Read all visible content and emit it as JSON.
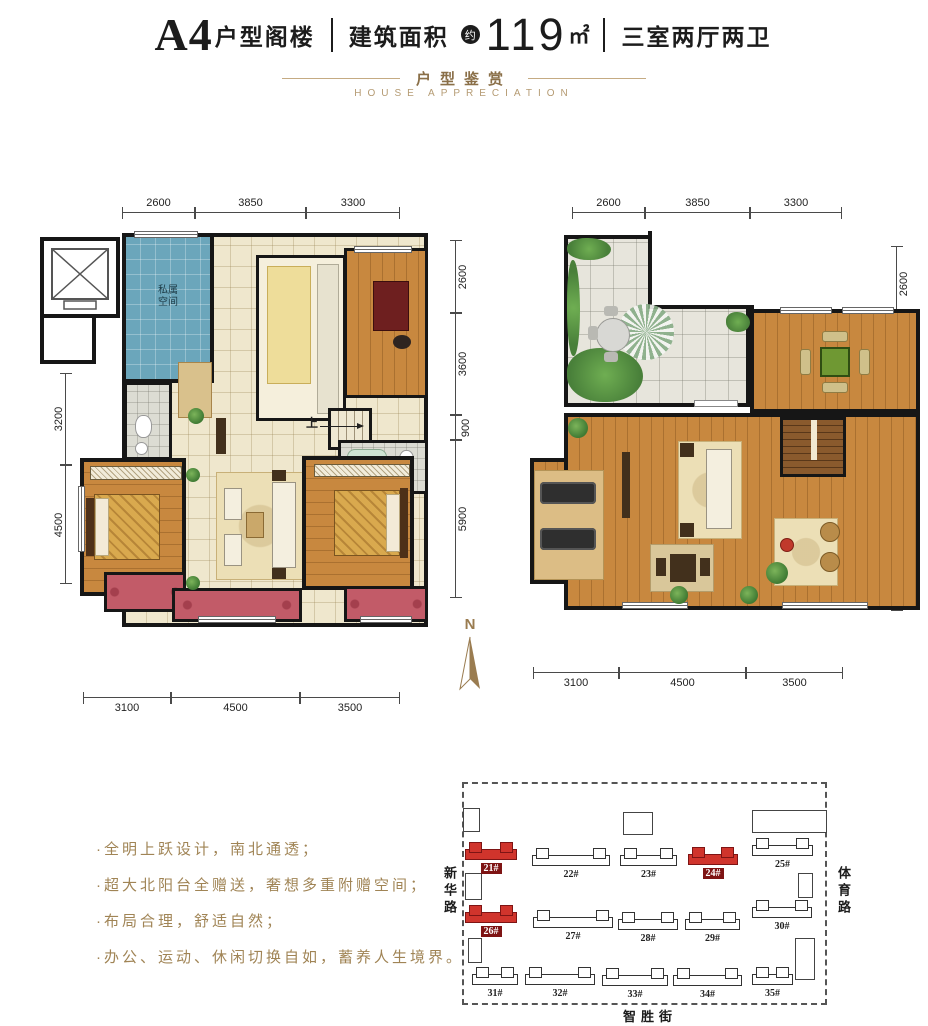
{
  "header": {
    "unit_code": "A4",
    "unit_type": "户型阁楼",
    "area_label": "建筑面积",
    "area_approx": "约",
    "area_value": "119",
    "area_unit": "㎡",
    "layout_desc": "三室两厅两卫",
    "subtitle_cn": "户型鉴赏",
    "subtitle_en": "HOUSE APPRECIATION"
  },
  "floor1": {
    "dims_top": [
      "2600",
      "3850",
      "3300"
    ],
    "dims_left": [
      "3200",
      "4500"
    ],
    "dims_right": [
      "2600",
      "3600",
      "900",
      "5900"
    ],
    "dims_bottom": [
      "3100",
      "4500",
      "3500"
    ],
    "room_private": "私属空间",
    "stairs_up": "上"
  },
  "floor2": {
    "dims_top": [
      "2600",
      "3850",
      "3300"
    ],
    "dims_right": [
      "2600",
      "10400"
    ],
    "dims_bottom": [
      "3100",
      "4500",
      "3500"
    ]
  },
  "compass_label": "N",
  "features": [
    "·全明上跃设计，南北通透；",
    "·超大北阳台全赠送，奢想多重附赠空间；",
    "·布局合理，舒适自然；",
    "·办公、运动、休闲切换自如，蓄养人生境界。"
  ],
  "sitemap": {
    "road_left": "新华路",
    "road_right": "体育路",
    "road_bottom": "智胜街",
    "buildings": [
      {
        "id": "21#",
        "highlight": true
      },
      {
        "id": "22#",
        "highlight": false
      },
      {
        "id": "23#",
        "highlight": false
      },
      {
        "id": "24#",
        "highlight": true
      },
      {
        "id": "25#",
        "highlight": false
      },
      {
        "id": "26#",
        "highlight": true
      },
      {
        "id": "27#",
        "highlight": false
      },
      {
        "id": "28#",
        "highlight": false
      },
      {
        "id": "29#",
        "highlight": false
      },
      {
        "id": "30#",
        "highlight": false
      },
      {
        "id": "31#",
        "highlight": false
      },
      {
        "id": "32#",
        "highlight": false
      },
      {
        "id": "33#",
        "highlight": false
      },
      {
        "id": "34#",
        "highlight": false
      },
      {
        "id": "35#",
        "highlight": false
      }
    ]
  },
  "colors": {
    "accent_brown": "#9a7c50",
    "highlight_red": "#d0342c",
    "badge_red": "#7e1414",
    "balcony_red": "#c25b68",
    "wood": "#c8883f",
    "floor_tile": "#efe7cd",
    "terrace_tile": "#e7e5dc",
    "private_blue": "#6ba6bb"
  }
}
